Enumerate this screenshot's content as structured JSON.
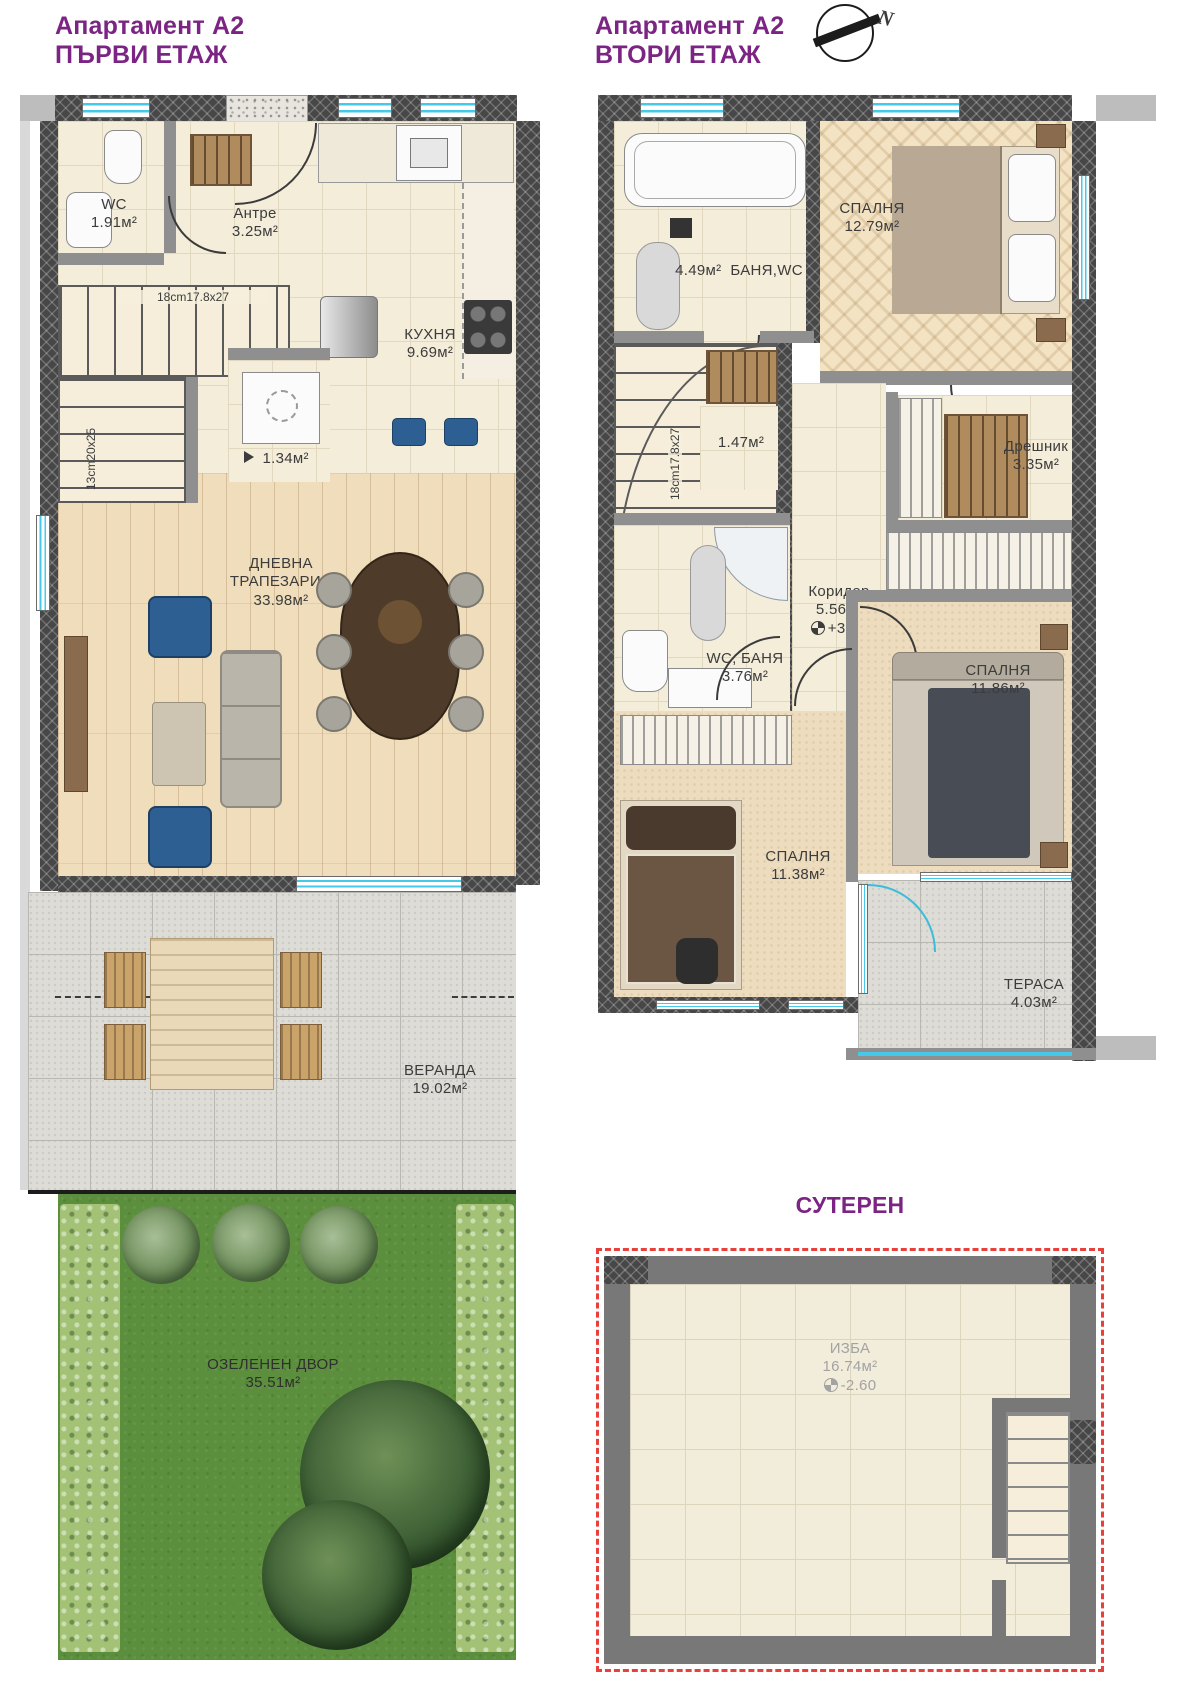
{
  "titles": {
    "floor1": {
      "line1": "Апартамент А2",
      "line2": "ПЪРВИ ЕТАЖ"
    },
    "floor2": {
      "line1": "Апартамент А2",
      "line2": "ВТОРИ ЕТАЖ"
    }
  },
  "compass": {
    "letter": "N"
  },
  "colors": {
    "accent_purple": "#7b2483",
    "window_cyan": "#46c8e8",
    "boundary_red": "#e8403a"
  },
  "floor1": {
    "rooms": [
      {
        "name": "WC",
        "area": "1.91м²"
      },
      {
        "name": "Антре",
        "area": "3.25м²"
      },
      {
        "name": "КУХНЯ",
        "area": "9.69м²"
      },
      {
        "name": "",
        "area": "1.34м²"
      },
      {
        "name": "ДНЕВНА ТРАПЕЗАРИЯ",
        "area": "33.98м²"
      },
      {
        "name": "ВЕРАНДА",
        "area": "19.02м²"
      },
      {
        "name": "ОЗЕЛЕНЕН ДВОР",
        "area": "35.51м²"
      }
    ],
    "stairs": {
      "upper": "18cm17.8x27",
      "lower": "13cm20x25"
    }
  },
  "floor2": {
    "rooms": [
      {
        "name": "БАНЯ,WC",
        "area": "4.49м²"
      },
      {
        "name": "СПАЛНЯ",
        "area": "12.79м²"
      },
      {
        "name": "",
        "area": "1.47м²"
      },
      {
        "name": "Дрешник",
        "area": "3.35м²"
      },
      {
        "name": "Коридор",
        "area": "5.56м²",
        "level": "+3.20"
      },
      {
        "name": "WC, БАНЯ",
        "area": "3.76м²"
      },
      {
        "name": "СПАЛНЯ",
        "area": "11.86м²"
      },
      {
        "name": "СПАЛНЯ",
        "area": "11.38м²"
      },
      {
        "name": "ТЕРАСА",
        "area": "4.03м²"
      }
    ],
    "stairs": {
      "label": "18cm17.8x27"
    }
  },
  "basement": {
    "title": "СУТЕРЕН",
    "room": "ИЗБА",
    "area": "16.74м²",
    "level": "-2.60"
  }
}
